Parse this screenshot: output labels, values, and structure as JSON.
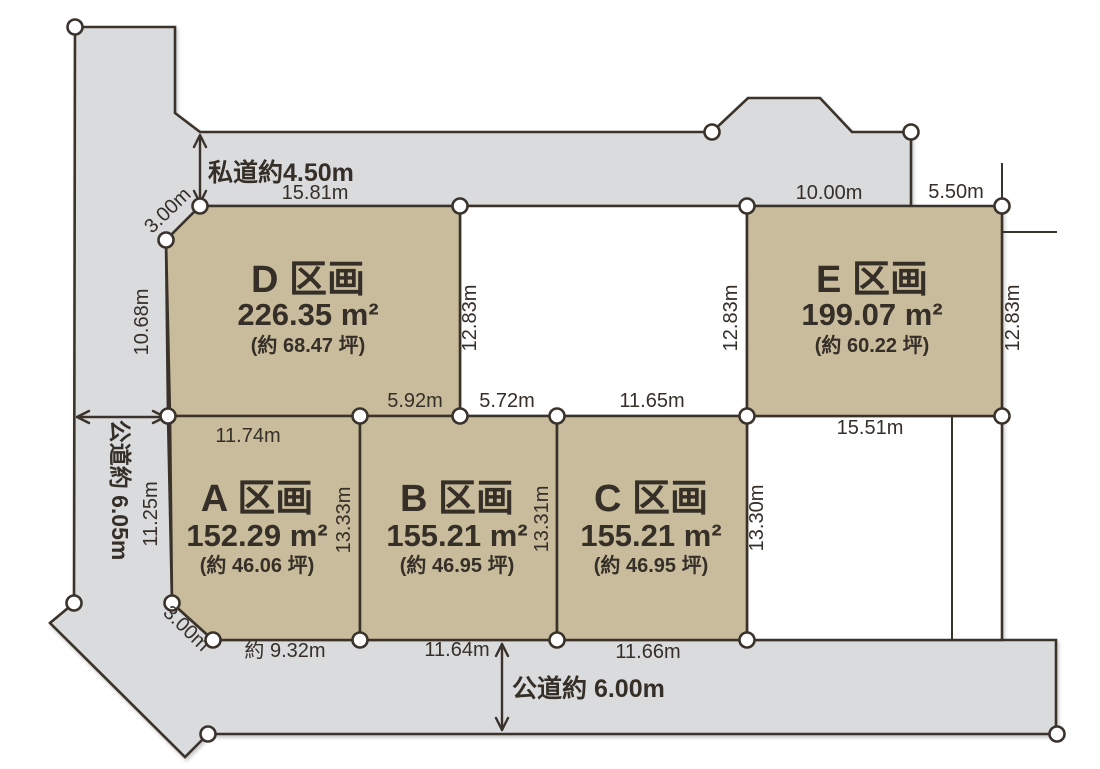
{
  "colors": {
    "plot_fill": "#c9bc9c",
    "road_fill": "#dadbdd",
    "empty_fill": "#ffffff",
    "line": "#3a332c",
    "text": "#352f28"
  },
  "plots": {
    "a": {
      "name": "A 区画",
      "area": "152.29 m²",
      "tsubo": "(約 46.06 坪)"
    },
    "b": {
      "name": "B 区画",
      "area": "155.21 m²",
      "tsubo": "(約 46.95 坪)"
    },
    "c": {
      "name": "C 区画",
      "area": "155.21 m²",
      "tsubo": "(約 46.95 坪)"
    },
    "d": {
      "name": "D 区画",
      "area": "226.35 m²",
      "tsubo": "(約 68.47 坪)"
    },
    "e": {
      "name": "E 区画",
      "area": "199.07 m²",
      "tsubo": "(約 60.22 坪)"
    }
  },
  "roads": {
    "private_top": "私道約4.50m",
    "public_left": "公道約 6.05m",
    "public_bottom": "公道約 6.00m"
  },
  "dims": {
    "d_top": "15.81m",
    "e_top_left": "10.00m",
    "e_top_right": "5.50m",
    "d_chamfer": "3.00m",
    "d_left": "10.68m",
    "mid_plot_left": "12.83m",
    "mid_plot_right": "12.83m",
    "e_right": "12.83m",
    "a_top": "11.74m",
    "b_top_left": "5.92m",
    "b_top_right": "5.72m",
    "c_top": "11.65m",
    "e_bottom": "15.51m",
    "a_left": "11.25m",
    "ab_boundary": "13.33m",
    "bc_boundary": "13.31m",
    "c_right": "13.30m",
    "a_chamfer": "3.00m",
    "a_bottom": "約 9.32m",
    "b_bottom": "11.64m",
    "c_bottom": "11.66m"
  }
}
